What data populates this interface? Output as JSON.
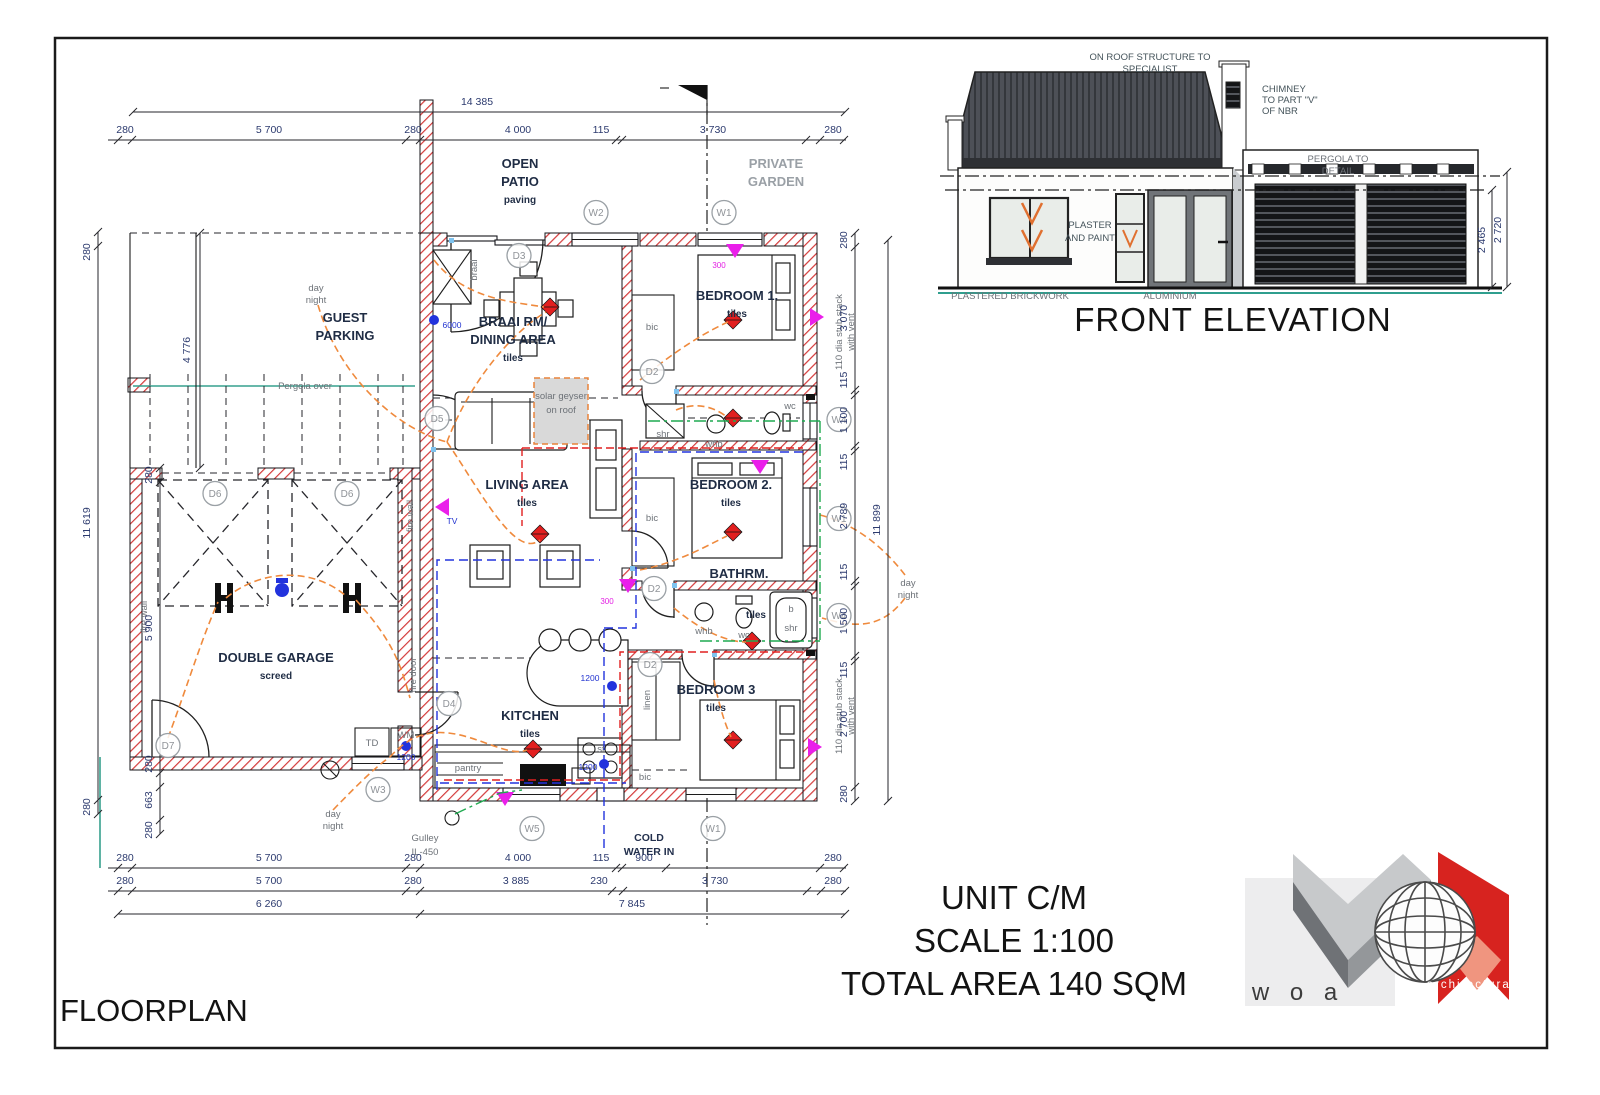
{
  "sheet": {
    "floorplan_label": "FLOORPLAN"
  },
  "titleblock": {
    "lines": [
      "UNIT C/M",
      "SCALE 1:100",
      "TOTAL AREA 140 SQM"
    ]
  },
  "elevation": {
    "title": "FRONT ELEVATION",
    "roof_note": [
      "ON ROOF STRUCTURE TO",
      "SPECIALIST"
    ],
    "chimney_note": [
      "CHIMNEY",
      "TO PART \"V\"",
      "OF NBR"
    ],
    "pergola_note": [
      "PERGOLA TO",
      "DETAIL"
    ],
    "plaster_note": [
      "PLASTER",
      "AND PAINT"
    ],
    "aluminium": "ALUMINIUM",
    "brickwork": "PLASTERED BRICKWORK",
    "dims": [
      "2 465",
      "2 720"
    ]
  },
  "logo": {
    "brand": "w o a",
    "tagline": [
      "architectural",
      "practice"
    ]
  },
  "plan": {
    "rooms": {
      "guest_parking": [
        "GUEST",
        "PARKING"
      ],
      "open_patio": [
        "OPEN",
        "PATIO"
      ],
      "private_garden": [
        "PRIVATE",
        "GARDEN"
      ],
      "braai_dining": [
        "BRAAI RM/",
        "DINING AREA"
      ],
      "living": "LIVING AREA",
      "kitchen": "KITCHEN",
      "bed1": "BEDROOM 1.",
      "bed2": "BEDROOM 2.",
      "bed3": "BEDROOM 3",
      "bathrm": "BATHRM.",
      "double_garage": "DOUBLE GARAGE"
    },
    "labels": {
      "tiles": "tiles",
      "paving": "paving",
      "screed": "screed",
      "pergola": "Pergola over",
      "day": "day",
      "night": "night",
      "fire_wall": "fire wall",
      "fire_door": "fire door",
      "braai": "braai",
      "pantry": "pantry",
      "bic": "bic",
      "linen": "linen",
      "shr": "shr",
      "whb": "whb",
      "wc": "wc",
      "b": "b",
      "st": "st",
      "td": "TD",
      "wm": "WM",
      "tv": "TV",
      "solar": [
        "solar geyser",
        "on roof"
      ],
      "cold_water": [
        "COLD",
        "WATER IN"
      ],
      "gulley": [
        "Gulley",
        "IL-450"
      ],
      "stub": [
        "110 dia stub stack",
        "with vent"
      ],
      "n6000": "6000",
      "n1200": "1200",
      "n300": "300"
    },
    "tags": {
      "d2": "D2",
      "d3": "D3",
      "d4": "D4",
      "d5": "D5",
      "d6": "D6",
      "d7": "D7",
      "w1": "W1",
      "w2": "W2",
      "w3": "W3",
      "w4": "W4",
      "w5": "W5"
    },
    "dims": {
      "top_overall": "14 385",
      "top": [
        "280",
        "5 700",
        "280",
        "4 000",
        "115",
        "3 730",
        "280"
      ],
      "bottom_row1": [
        "280",
        "5 700",
        "280",
        "4 000",
        "115",
        "900",
        "280"
      ],
      "bottom_row2": [
        "280",
        "5 700",
        "280",
        "3 885",
        "230",
        "3 730",
        "280"
      ],
      "bottom_row3": [
        "6 260",
        "7 845"
      ],
      "left_outer": [
        "280",
        "11 619",
        "280"
      ],
      "left_inner": [
        "280",
        "5 900",
        "280",
        "663",
        "280"
      ],
      "parking_depth": "4 776",
      "right_inner": [
        "280",
        "3 070",
        "115",
        "1 100",
        "115",
        "2 789",
        "115",
        "1 500",
        "115",
        "2 700",
        "280"
      ],
      "right_overall": "11 899"
    }
  }
}
